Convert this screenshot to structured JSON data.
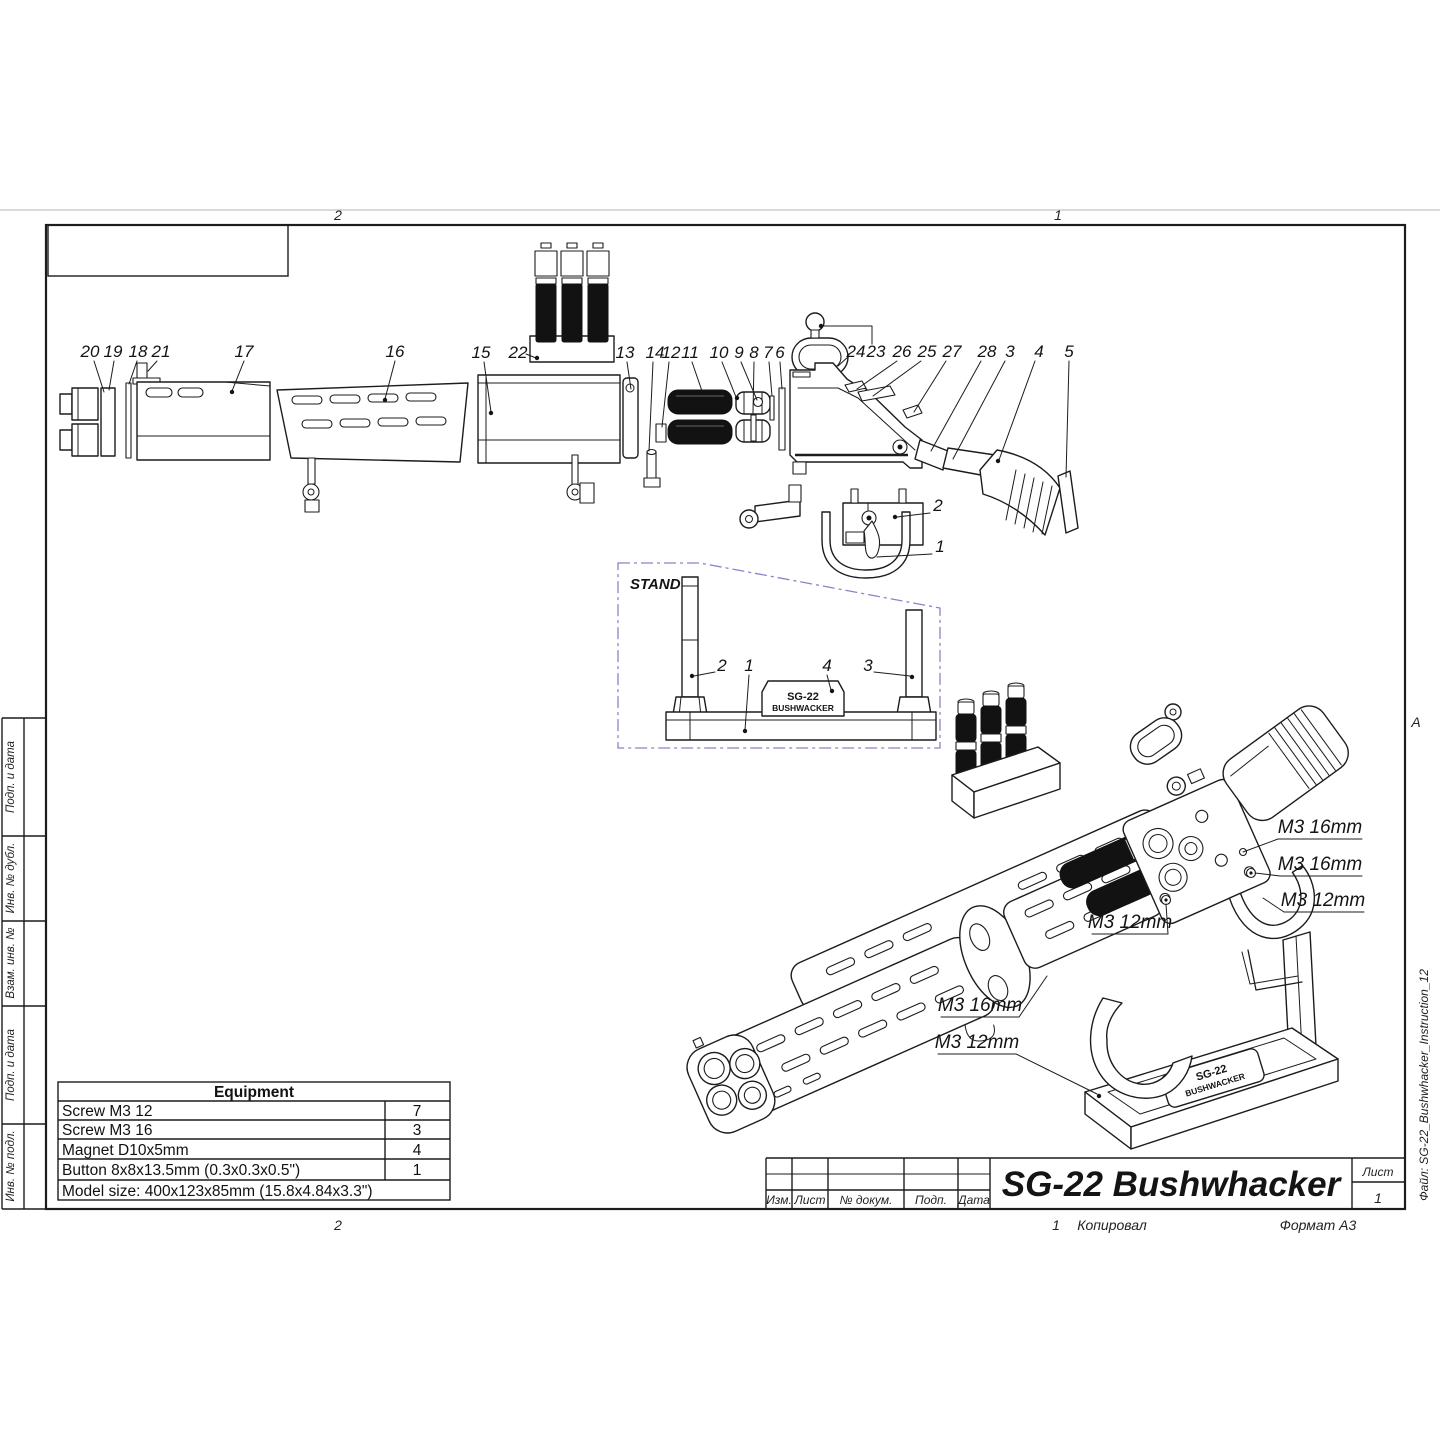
{
  "sheet": {
    "zones": {
      "top_left": "2",
      "top_right": "1",
      "bottom_left": "2",
      "bottom_right_num": "1",
      "right_letter": "A"
    },
    "footer": {
      "copied": "Копировал",
      "format": "Формат А3"
    },
    "file_label": "Файл: SG-22_Bushwhacker_Instruction_12",
    "margin_labels": [
      "Подп. и дата",
      "Инв. № дубл.",
      "Взам. инв. №",
      "Подп. и дата",
      "Инв. № подл."
    ]
  },
  "title_block": {
    "title": "SG-22 Bushwhacker",
    "columns": [
      "Изм.",
      "Лист",
      "№ докум.",
      "Подп.",
      "Дата"
    ],
    "sheet_label": "Лист",
    "sheet_number": "1"
  },
  "equipment": {
    "header": "Equipment",
    "rows": [
      {
        "name": "Screw M3 12",
        "qty": "7"
      },
      {
        "name": "Screw M3 16",
        "qty": "3"
      },
      {
        "name": "Magnet D10x5mm",
        "qty": "4"
      },
      {
        "name": "Button 8x8x13.5mm (0.3x0.3x0.5\")",
        "qty": "1"
      }
    ],
    "footer": "Model size: 400x123x85mm (15.8x4.84x3.3\")"
  },
  "exploded": {
    "callouts": [
      "20",
      "19",
      "18",
      "21",
      "17",
      "16",
      "15",
      "22",
      "13",
      "14",
      "12",
      "11",
      "10",
      "9",
      "8",
      "7",
      "6",
      "24",
      "23",
      "26",
      "25",
      "27",
      "28",
      "3",
      "4",
      "5"
    ],
    "trigger_callouts": [
      "2",
      "1"
    ]
  },
  "stand": {
    "label": "STAND",
    "box_color": "#8486c8",
    "plate": [
      "SG-22",
      "BUSHWACKER"
    ],
    "callouts": [
      "2",
      "1",
      "4",
      "3"
    ]
  },
  "assembled": {
    "screw_labels": [
      "M3 16mm",
      "M3 16mm",
      "M3 12mm",
      "M3 12mm",
      "M3 16mm",
      "M3 12mm"
    ],
    "plate": [
      "SG-22",
      "BUSHWACKER"
    ]
  }
}
